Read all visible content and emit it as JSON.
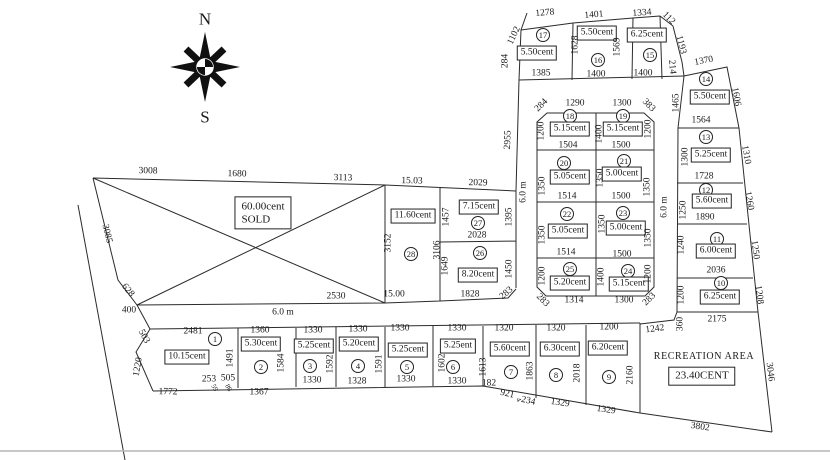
{
  "compass": {
    "north": "N",
    "south": "S"
  },
  "roads": {
    "v_left": "6.0 m",
    "v_right": "6.0 m",
    "bottom": "6.0 m"
  },
  "misc": {
    "edge2955": "2955"
  },
  "sold": {
    "area": "60.00cent",
    "status": "SOLD",
    "top1": "3008",
    "top2": "1680",
    "top3": "3113",
    "left": "3085",
    "left2": "628",
    "left3": "400",
    "bottom": "2530"
  },
  "p28": {
    "num": "28",
    "area": "11.60cent",
    "top": "15.03",
    "left": "3152",
    "right": "3106",
    "bottom": "15.00"
  },
  "p27": {
    "num": "27",
    "area": "7.15cent",
    "top": "2029",
    "left": "1457",
    "right": "1395",
    "bottom": "2028"
  },
  "p26": {
    "num": "26",
    "area": "8.20cent",
    "left": "1649",
    "right": "1450",
    "bottom": "1828",
    "corner": "283"
  },
  "top_block": {
    "left_diag": "1102",
    "left": "284",
    "right_diag": "112",
    "right1": "1193",
    "right2": "214",
    "p17": {
      "num": "17",
      "area": "5.50cent",
      "top": "1278",
      "bottom": "1385"
    },
    "p16": {
      "num": "16",
      "area": "5.50cent",
      "top": "1401",
      "left": "1628",
      "right": "1569",
      "bottom": "1400"
    },
    "p15": {
      "num": "15",
      "area": "6.25cent",
      "top": "1334",
      "bottom": "1400"
    }
  },
  "mid": {
    "corner_tl": "284",
    "corner_tr": "383",
    "corner_bl": "283",
    "corner_br": "283",
    "mid1": "1400",
    "mid2": "1350",
    "mid3": "1350",
    "mid4": "1400",
    "p18": {
      "num": "18",
      "area": "5.15cent",
      "top": "1290",
      "left": "1200",
      "bottom": "1504"
    },
    "p19": {
      "num": "19",
      "area": "5.15cent",
      "top": "1300",
      "right": "1200",
      "bottom": "1500"
    },
    "p20": {
      "num": "20",
      "area": "5.05cent",
      "left": "1350",
      "bottom": "1514"
    },
    "p21": {
      "num": "21",
      "area": "5.00cent",
      "right": "1350",
      "bottom": "1500"
    },
    "p22": {
      "num": "22",
      "area": "5.05cent",
      "left": "1350",
      "bottom": "1514"
    },
    "p23": {
      "num": "23",
      "area": "5.00cent",
      "right": "1350",
      "bottom": "1500"
    },
    "p24": {
      "num": "24",
      "area": "5.15cent",
      "right": "1200",
      "bottom": "1300"
    },
    "p25": {
      "num": "25",
      "area": "5.20cent",
      "left": "1200",
      "bottom": "1314"
    }
  },
  "rcol": {
    "below": "360",
    "p14": {
      "num": "14",
      "area": "5.50cent",
      "top": "1370",
      "left": "1465",
      "right": "1606",
      "bottom": "1564"
    },
    "p13": {
      "num": "13",
      "area": "5.25cent",
      "left": "1300",
      "right": "1310",
      "bottom": "1728"
    },
    "p12": {
      "num": "12",
      "area": "5.60cent",
      "left": "1250",
      "right": "1260",
      "bottom": "1890"
    },
    "p11": {
      "num": "11",
      "area": "6.00cent",
      "left": "1240",
      "right": "1250",
      "bottom": "2036"
    },
    "p10": {
      "num": "10",
      "area": "6.25cent",
      "left": "1200",
      "right": "1208",
      "bottom": "2175"
    }
  },
  "brow": {
    "p1": {
      "num": "1",
      "area": "10.15cent",
      "top": "2481",
      "left1": "503",
      "left2": "1220",
      "right": "1491",
      "b1": "253",
      "b2": "505",
      "b3": "59",
      "b4": "86",
      "bottom": "1772"
    },
    "p2": {
      "num": "2",
      "area": "5.30cent",
      "top": "1360",
      "right": "1584",
      "bottom": "1367"
    },
    "p3": {
      "num": "3",
      "area": "5.25cent",
      "top": "1330",
      "right": "1592",
      "bottom": "1330"
    },
    "p4": {
      "num": "4",
      "area": "5.20cent",
      "top": "1330",
      "right": "1591",
      "bottom": "1328"
    },
    "p5": {
      "num": "5",
      "area": "5.25cent",
      "top": "1330",
      "bottom": "1330"
    },
    "p6": {
      "num": "6",
      "area": "5.25ent",
      "top": "1330",
      "left": "1602",
      "bottom": "1330"
    },
    "p7": {
      "num": "7",
      "area": "5.60cent",
      "top": "1320",
      "left": "1613",
      "right": "1863",
      "b1": "182",
      "b2": "921",
      "b3": "4",
      "b4": "234"
    },
    "p8": {
      "num": "8",
      "area": "6.30cent",
      "top": "1320",
      "right": "2018",
      "bottom": "1329"
    },
    "p9": {
      "num": "9",
      "area": "6.20cent",
      "top": "1200",
      "right": "2160",
      "bottom": "1329"
    }
  },
  "rec": {
    "name": "RECREATION AREA",
    "area": "23.40CENT",
    "top_left": "1242",
    "right": "3046",
    "bottom": "3802"
  }
}
